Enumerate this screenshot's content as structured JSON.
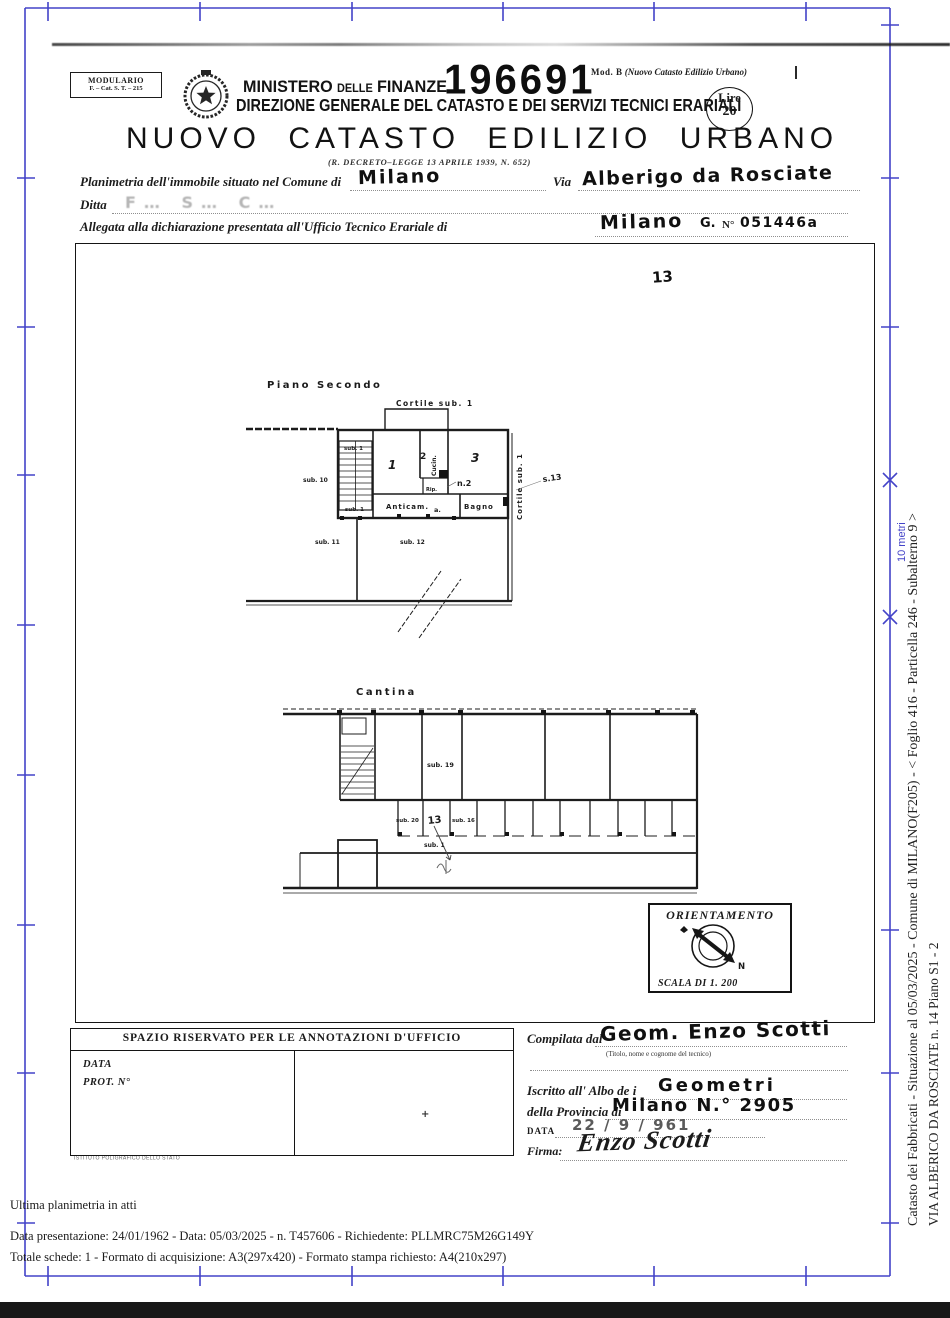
{
  "header": {
    "modulario": {
      "line1": "MODULARIO",
      "line2": "F. – Cat. S. T. – 215"
    },
    "ministry": {
      "word1": "MINISTERO",
      "word2": "DELLE",
      "word3": "FINANZE"
    },
    "stamp_number": "196691",
    "mod_b": {
      "prefix": "Mod. B",
      "suffix": "(Nuovo Catasto Edilizio Urbano)"
    },
    "direzione": "DIREZIONE GENERALE DEL CATASTO E DEI SERVIZI TECNICI ERARIALI",
    "bollo": {
      "line1": "Lire",
      "line2": "20"
    },
    "title": "NUOVO CATASTO EDILIZIO URBANO",
    "decree": "(R. DECRETO–LEGGE 13 APRILE 1939, N. 652)"
  },
  "form": {
    "comune_label": "Planimetria dell'immobile situato nel Comune di",
    "comune_value": "Milano",
    "via_label": "Via",
    "via_value": "Alberigo da Rosciate",
    "ditta_label": "Ditta",
    "ditta_value": "F…   S…   C…",
    "ufficio_label": "Allegata alla dichiarazione presentata all'Ufficio Tecnico Erariale di",
    "ufficio_value": "Milano",
    "g_value": "G.",
    "n_label": "N°",
    "n_value": "051446a"
  },
  "plan": {
    "sheet_note": "13",
    "piano_secondo": {
      "title": "Piano Secondo",
      "cortile_top": "Cortile sub. 1",
      "cortile_right": "Cortile sub. 1",
      "stair_sub": "sub. 1",
      "stair_sub_bottom": "sub. 1",
      "sub10": "sub. 10",
      "sub11": "sub. 11",
      "sub12": "sub. 12",
      "room1": "1",
      "room2": "2",
      "room3": "3",
      "cucina": "Cucin.",
      "rip": "Rip.",
      "anticamera": "Anticam.",
      "door_note": "a.",
      "bagno": "Bagno",
      "pencil_2": "n.2",
      "pencil_13": "s.13"
    },
    "cantina": {
      "title": "Cantina",
      "sub19": "sub. 19",
      "sub20": "sub. 20",
      "pencil_13": "13",
      "sub16": "sub. 16",
      "sub1": "sub. 1"
    },
    "orientation": {
      "title": "ORIENTAMENTO",
      "north": "N",
      "scale": "SCALA DI 1. 200"
    }
  },
  "annotations": {
    "header": "SPAZIO RISERVATO PER LE ANNOTAZIONI D'UFFICIO",
    "data_label": "DATA",
    "prot_label": "PROT. N°",
    "pencil_mark": "+",
    "printer": "ISTITUTO POLIGRAFICO DELLO STATO"
  },
  "compiler": {
    "compilata_label": "Compilata dal",
    "compilata_value": "Geom. Enzo Scotti",
    "hint": "(Titolo, nome e cognome del tecnico)",
    "albo_label": "Iscritto all' Albo de i",
    "albo_value": "Geometri",
    "provincia_label": "della Provincia di",
    "provincia_value": "Milano N.° 2905",
    "data_label": "DATA",
    "data_value": "22 / 9 / 961",
    "firma_label": "Firma:",
    "firma_value": "Enzo Scotti"
  },
  "footer": {
    "line1": "Ultima planimetria in atti",
    "line2": "Data presentazione: 24/01/1962 - Data: 05/03/2025 - n. T457606 - Richiedente: PLLMRC75M26G149Y",
    "line3": "Totale schede: 1 - Formato di acquisizione: A3(297x420)  - Formato stampa richiesto: A4(210x297)"
  },
  "margin": {
    "scale_bar_label": "10 metri",
    "vertical_line1": "Catasto dei Fabbricati - Situazione al 05/03/2025 - Comune di MILANO(F205) - <  Foglio 416 - Particella 246 - Subalterno 9 >",
    "vertical_line2": "VIA ALBERICO DA ROSCIATE n. 14 Piano S1 - 2"
  },
  "colors": {
    "frame_blue": "#4343c8",
    "ink": "#1b1b1b",
    "bar_black": "#181818"
  }
}
